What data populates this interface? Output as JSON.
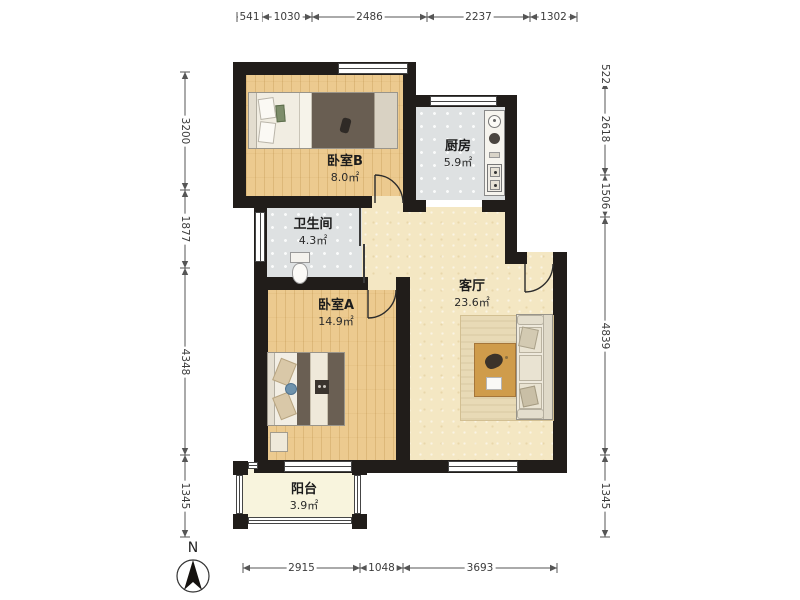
{
  "rooms": {
    "bedroom_b": {
      "name": "卧室B",
      "area": "8.0㎡"
    },
    "kitchen": {
      "name": "厨房",
      "area": "5.9㎡"
    },
    "bathroom": {
      "name": "卫生间",
      "area": "4.3㎡"
    },
    "bedroom_a": {
      "name": "卧室A",
      "area": "14.9㎡"
    },
    "living": {
      "name": "客厅",
      "area": "23.6㎡"
    },
    "balcony": {
      "name": "阳台",
      "area": "3.9㎡"
    }
  },
  "dimensions": {
    "top": [
      "541",
      "1030",
      "2486",
      "2237",
      "1302"
    ],
    "bottom": [
      "2915",
      "1048",
      "3693"
    ],
    "left": [
      "3200",
      "1877",
      "4348",
      "1345"
    ],
    "right": [
      "522",
      "2618",
      "1506",
      "4839",
      "1345"
    ]
  },
  "compass": {
    "label": "N"
  },
  "colors": {
    "wall": "#211d1a",
    "wood_floor": "#ecca8f",
    "tile_floor": "#dee1e2",
    "living_floor": "#f4e7c3",
    "balcony_floor": "#f8f4dd",
    "dimension_text": "#3c3c3c",
    "blanket": "#695e52",
    "sofa": "#eee9dc",
    "table_wood": "#cf9c4b"
  }
}
